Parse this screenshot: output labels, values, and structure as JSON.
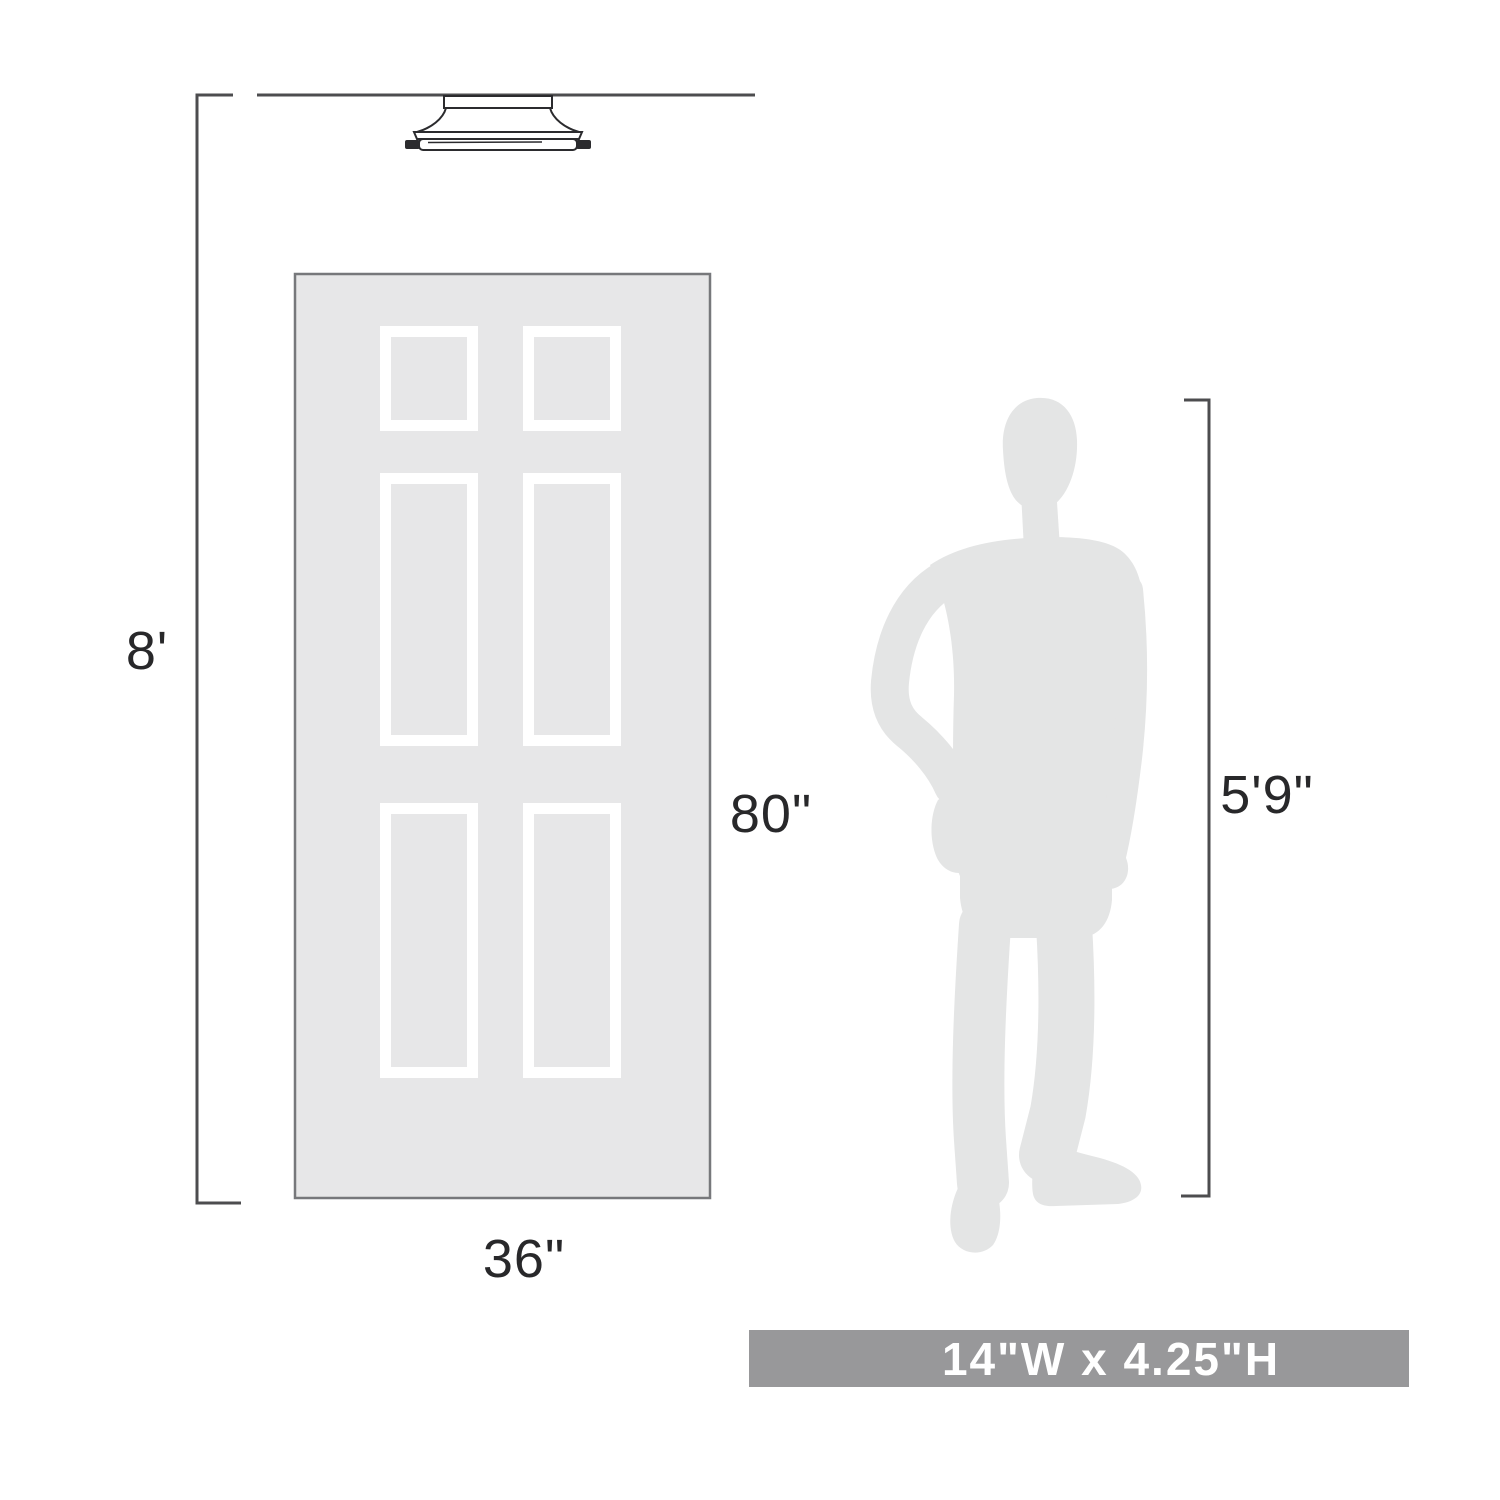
{
  "labels": {
    "ceiling_height": "8'",
    "door_height": "80\"",
    "door_width": "36\"",
    "person_height": "5'9\""
  },
  "banner": {
    "fixture_size": "14\"W x 4.25\"H"
  },
  "colors": {
    "line_color": "#4d4d4f",
    "text_color": "#28282a",
    "door_fill": "#e7e7e8",
    "door_border": "#77787b",
    "panel_frame": "#ffffff",
    "silhouette": "#e4e5e5",
    "fixture_line": "#2b2b2e",
    "banner_bg": "#98989a",
    "banner_text": "#ffffff",
    "background": "#ffffff"
  }
}
